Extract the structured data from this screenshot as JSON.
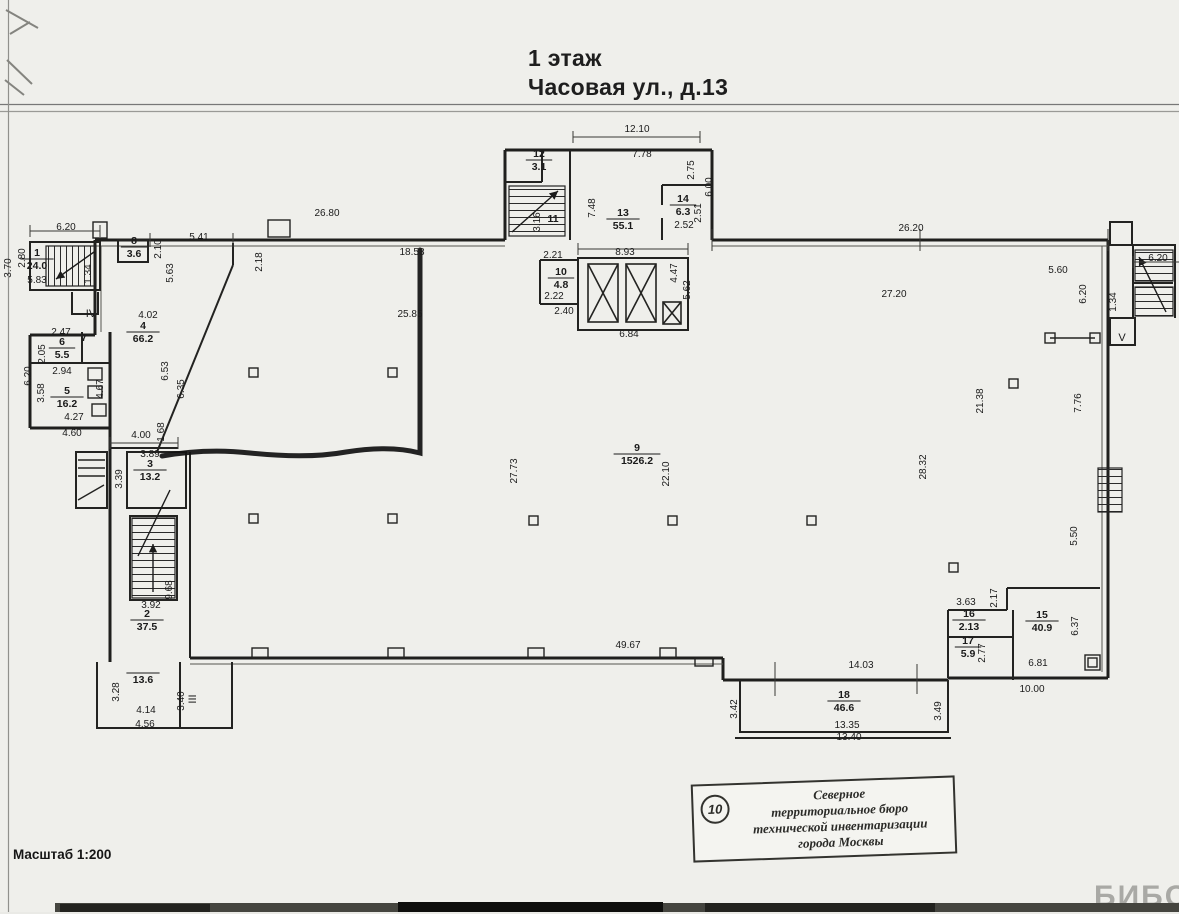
{
  "header": {
    "line1": "1 этаж",
    "line2": "Часовая ул., д.13"
  },
  "footer": {
    "scale": "Масштаб 1:200",
    "watermark": "БИБОСС"
  },
  "stamp": {
    "number": "10",
    "lines": [
      "Северное",
      "территориальное бюро",
      "технической инвентаризации",
      "города Москвы"
    ]
  },
  "plan": {
    "rooms": [
      {
        "num": "1",
        "area": "24.0",
        "x": 37,
        "y": 256
      },
      {
        "num": "8",
        "area": "3.6",
        "x": 134,
        "y": 244
      },
      {
        "num": "12",
        "area": "3.1",
        "x": 539,
        "y": 157
      },
      {
        "num": "11",
        "area": "",
        "x": 553,
        "y": 222
      },
      {
        "num": "13",
        "area": "55.1",
        "x": 623,
        "y": 216
      },
      {
        "num": "14",
        "area": "6.3",
        "x": 683,
        "y": 202
      },
      {
        "num": "10",
        "area": "4.8",
        "x": 561,
        "y": 275
      },
      {
        "num": "4",
        "area": "66.2",
        "x": 143,
        "y": 329
      },
      {
        "num": "6",
        "area": "5.5",
        "x": 62,
        "y": 345
      },
      {
        "num": "7",
        "area": "",
        "x": 84,
        "y": 341
      },
      {
        "num": "5",
        "area": "16.2",
        "x": 67,
        "y": 394
      },
      {
        "num": "3",
        "area": "13.2",
        "x": 150,
        "y": 467
      },
      {
        "num": "9",
        "area": "1526.2",
        "x": 637,
        "y": 451
      },
      {
        "num": "2",
        "area": "37.5",
        "x": 147,
        "y": 617
      },
      {
        "num": "",
        "area": "13.6",
        "x": 143,
        "y": 670
      },
      {
        "num": "16",
        "area": "2.13",
        "x": 969,
        "y": 617
      },
      {
        "num": "17",
        "area": "5.9",
        "x": 968,
        "y": 644
      },
      {
        "num": "15",
        "area": "40.9",
        "x": 1042,
        "y": 618
      },
      {
        "num": "18",
        "area": "46.6",
        "x": 844,
        "y": 698
      }
    ],
    "dims": [
      {
        "t": "6.20",
        "x": 66,
        "y": 230
      },
      {
        "t": "3.70",
        "x": 11,
        "y": 268,
        "r": -90
      },
      {
        "t": "2.80",
        "x": 25,
        "y": 258,
        "r": -90
      },
      {
        "t": "5.83",
        "x": 37,
        "y": 283
      },
      {
        "t": "1.34",
        "x": 91,
        "y": 274,
        "r": -90
      },
      {
        "t": "5.41",
        "x": 199,
        "y": 240
      },
      {
        "t": "2.10",
        "x": 161,
        "y": 249,
        "r": -90
      },
      {
        "t": "26.80",
        "x": 327,
        "y": 216
      },
      {
        "t": "2.18",
        "x": 262,
        "y": 262,
        "r": -90
      },
      {
        "t": "18.58",
        "x": 412,
        "y": 255
      },
      {
        "t": "25.85",
        "x": 410,
        "y": 317
      },
      {
        "t": "5.63",
        "x": 173,
        "y": 273,
        "r": -90
      },
      {
        "t": "4.02",
        "x": 148,
        "y": 318
      },
      {
        "t": "6.53",
        "x": 168,
        "y": 371,
        "r": -90
      },
      {
        "t": "6.35",
        "x": 184,
        "y": 389,
        "r": -90
      },
      {
        "t": "2.47",
        "x": 61,
        "y": 335
      },
      {
        "t": "2.05",
        "x": 45,
        "y": 354,
        "r": -90
      },
      {
        "t": "2.94",
        "x": 62,
        "y": 374
      },
      {
        "t": "6.20",
        "x": 31,
        "y": 376,
        "r": -90
      },
      {
        "t": "3.58",
        "x": 44,
        "y": 393,
        "r": -90
      },
      {
        "t": "4.67",
        "x": 103,
        "y": 389,
        "r": -90
      },
      {
        "t": "4.27",
        "x": 74,
        "y": 420
      },
      {
        "t": "4.60",
        "x": 72,
        "y": 436
      },
      {
        "t": "4.00",
        "x": 141,
        "y": 438
      },
      {
        "t": "1.68",
        "x": 164,
        "y": 432,
        "r": -90
      },
      {
        "t": "3.89",
        "x": 150,
        "y": 457
      },
      {
        "t": "3.39",
        "x": 122,
        "y": 479,
        "r": -90
      },
      {
        "t": "3.92",
        "x": 151,
        "y": 608
      },
      {
        "t": "9.68",
        "x": 172,
        "y": 590,
        "r": -90
      },
      {
        "t": "3.28",
        "x": 119,
        "y": 692,
        "r": -90
      },
      {
        "t": "4.14",
        "x": 146,
        "y": 713
      },
      {
        "t": "4.56",
        "x": 145,
        "y": 727
      },
      {
        "t": "3.40",
        "x": 184,
        "y": 701,
        "r": -90
      },
      {
        "t": "12.10",
        "x": 637,
        "y": 132
      },
      {
        "t": "7.78",
        "x": 642,
        "y": 157
      },
      {
        "t": "3.16",
        "x": 540,
        "y": 222,
        "r": -90
      },
      {
        "t": "7.48",
        "x": 595,
        "y": 208,
        "r": -90
      },
      {
        "t": "2.75",
        "x": 694,
        "y": 170,
        "r": -90
      },
      {
        "t": "6.00",
        "x": 712,
        "y": 187,
        "r": -90
      },
      {
        "t": "2.52",
        "x": 684,
        "y": 228
      },
      {
        "t": "2.51",
        "x": 701,
        "y": 213,
        "r": -90
      },
      {
        "t": "2.21",
        "x": 553,
        "y": 258
      },
      {
        "t": "2.22",
        "x": 554,
        "y": 299
      },
      {
        "t": "2.40",
        "x": 564,
        "y": 314
      },
      {
        "t": "8.93",
        "x": 625,
        "y": 255
      },
      {
        "t": "4.47",
        "x": 677,
        "y": 273,
        "r": -90
      },
      {
        "t": "5.62",
        "x": 690,
        "y": 290,
        "r": -90
      },
      {
        "t": "6.84",
        "x": 629,
        "y": 337
      },
      {
        "t": "26.20",
        "x": 911,
        "y": 231
      },
      {
        "t": "6.20",
        "x": 1158,
        "y": 261
      },
      {
        "t": "5.60",
        "x": 1058,
        "y": 273
      },
      {
        "t": "6.20",
        "x": 1086,
        "y": 294,
        "r": -90
      },
      {
        "t": "1.34",
        "x": 1116,
        "y": 302,
        "r": -90
      },
      {
        "t": "27.20",
        "x": 894,
        "y": 297
      },
      {
        "t": "27.73",
        "x": 517,
        "y": 471,
        "r": -90
      },
      {
        "t": "22.10",
        "x": 669,
        "y": 474,
        "r": -90
      },
      {
        "t": "21.38",
        "x": 983,
        "y": 401,
        "r": -90
      },
      {
        "t": "7.76",
        "x": 1081,
        "y": 403,
        "r": -90
      },
      {
        "t": "28.32",
        "x": 926,
        "y": 467,
        "r": -90
      },
      {
        "t": "5.50",
        "x": 1077,
        "y": 536,
        "r": -90
      },
      {
        "t": "3.63",
        "x": 966,
        "y": 605
      },
      {
        "t": "2.17",
        "x": 997,
        "y": 598,
        "r": -90
      },
      {
        "t": "2.77",
        "x": 985,
        "y": 653,
        "r": -90
      },
      {
        "t": "6.37",
        "x": 1078,
        "y": 626,
        "r": -90
      },
      {
        "t": "6.81",
        "x": 1038,
        "y": 666
      },
      {
        "t": "10.00",
        "x": 1032,
        "y": 692
      },
      {
        "t": "49.67",
        "x": 628,
        "y": 648
      },
      {
        "t": "14.03",
        "x": 861,
        "y": 668
      },
      {
        "t": "13.35",
        "x": 847,
        "y": 728
      },
      {
        "t": "13.40",
        "x": 849,
        "y": 740
      },
      {
        "t": "3.42",
        "x": 737,
        "y": 709,
        "r": -90
      },
      {
        "t": "3.49",
        "x": 941,
        "y": 711,
        "r": -90
      }
    ],
    "marks": [
      {
        "t": "IV",
        "x": 91,
        "y": 317
      },
      {
        "t": "III",
        "x": 196,
        "y": 699,
        "r": -90
      },
      {
        "t": "V",
        "x": 1122,
        "y": 341
      }
    ]
  }
}
